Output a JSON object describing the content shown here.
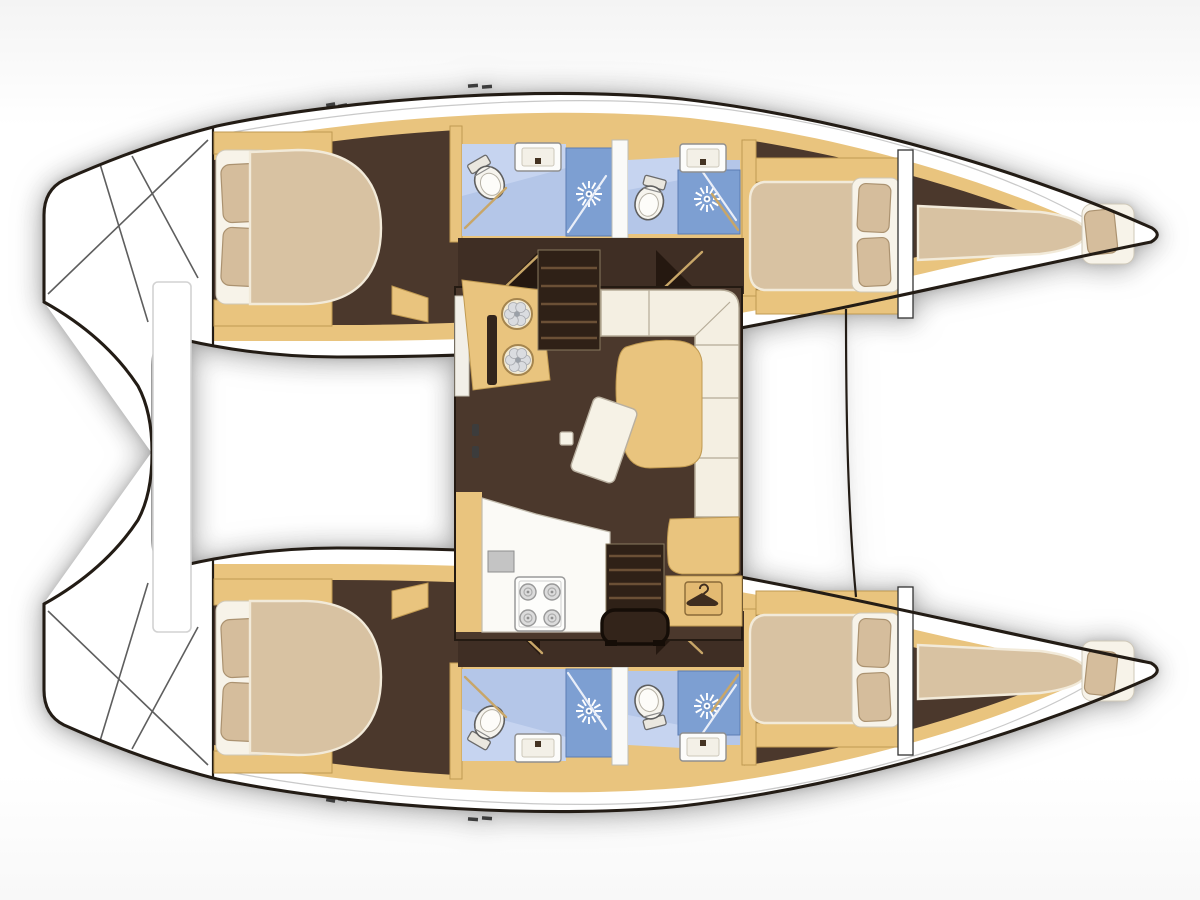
{
  "page": {
    "title": "Catamaran interior layout plan — top view, bow to the right",
    "type": "boat-floorplan",
    "orientation": {
      "bow": "right",
      "stern": "left"
    }
  },
  "colors": {
    "line": "#231c15",
    "hullWhite": "#ffffff",
    "deckLine": "#c9c9c9",
    "wood": "#e9c47e",
    "woodEdge": "#c09a52",
    "woodDeep": "#e3ba72",
    "floor": "#4b382c",
    "floorDark": "#3f2e24",
    "floorDarkest": "#251810",
    "stairWood": "#2f2117",
    "tread": "#6b5036",
    "mattress": "#d8c2a2",
    "mattressGlow": "#f2ead9",
    "sheet": "#f7f3e9",
    "sheetEdge": "#cfc8b8",
    "pillow": "#d5bd9c",
    "pillowEdge": "#ab9270",
    "cushion": "#f4efe2",
    "cushionEdge": "#b5ab97",
    "bathBlue": "#b4c6e8",
    "bathBlueHi": "#c6d4f0",
    "showerBlue": "#7d9fd2",
    "showerEdge": "#5b7cb4",
    "swing": "#c8a668",
    "applianceGray": "#c4c4c4",
    "fixtureEdge": "#8f8f8f"
  },
  "rooms": {
    "salon": {
      "label": "Salon / galley on bridgedeck",
      "fixtures": [
        "galley-block-two-burners",
        "galley-counter",
        "fridge",
        "four-burner-stove",
        "companionway-stairs-port",
        "companionway-stairs-starboard",
        "entry-threshold",
        "l-shaped-sofa",
        "dining-table",
        "chart-table",
        "stool",
        "wardrobe-with-hanger"
      ]
    },
    "port_hull": {
      "label": "Port hull (top)",
      "compartments": [
        {
          "name": "transom-steps",
          "features": [
            "swim-steps"
          ]
        },
        {
          "name": "aft-cabin",
          "features": [
            "double-bed",
            "two-pillows",
            "corner-shelf"
          ]
        },
        {
          "name": "aft-head",
          "features": [
            "toilet",
            "sink",
            "shower-cabin",
            "door-swing"
          ]
        },
        {
          "name": "forward-head",
          "features": [
            "toilet",
            "sink",
            "shower-cabin",
            "door-swing"
          ]
        },
        {
          "name": "forward-cabin",
          "features": [
            "double-bed",
            "two-pillows"
          ]
        },
        {
          "name": "forepeak-berth",
          "features": [
            "single-berth",
            "pillow"
          ]
        }
      ]
    },
    "starboard_hull": {
      "label": "Starboard hull (bottom)",
      "mirror_of": "port_hull"
    },
    "deck": {
      "label": "Deck structures",
      "features": [
        "aft-crossbeam-platform",
        "forward-crossbeam-line",
        "deck-cleats"
      ]
    }
  },
  "icons": [
    {
      "name": "shower-head-icon",
      "glyph": "white starburst on blue"
    },
    {
      "name": "toilet-icon",
      "glyph": "oval bowl with tank"
    },
    {
      "name": "sink-icon",
      "glyph": "rounded rectangle basin"
    },
    {
      "name": "burner-icon",
      "glyph": "petal flower circle"
    },
    {
      "name": "stove-burner-icon",
      "glyph": "concentric circles"
    },
    {
      "name": "hanger-icon",
      "glyph": "clothes hanger"
    }
  ]
}
